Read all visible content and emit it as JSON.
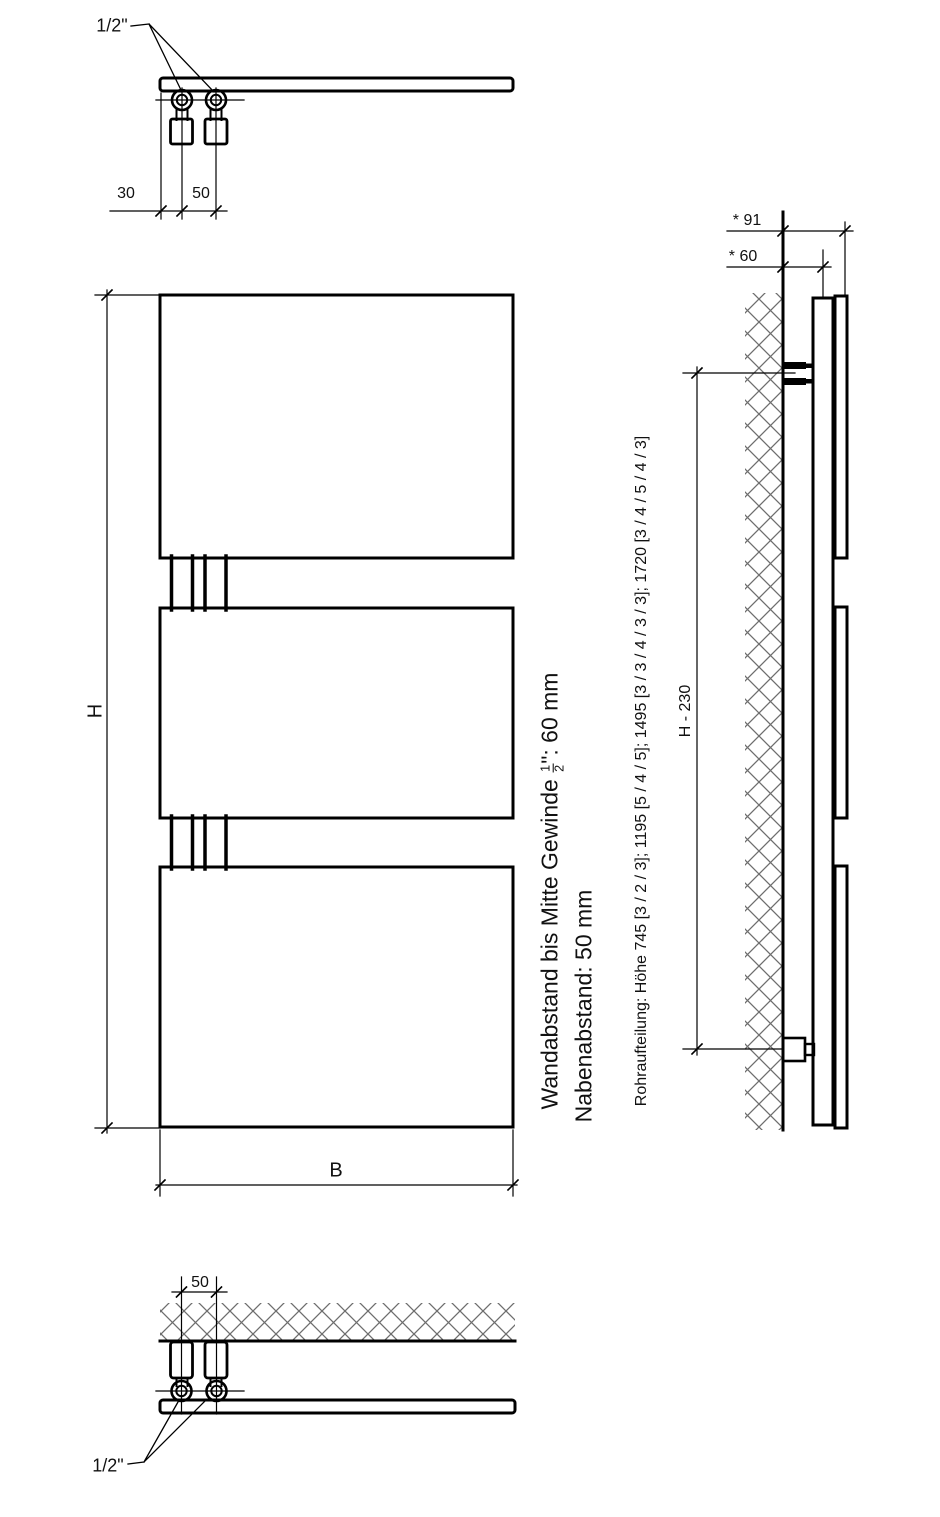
{
  "drawing": {
    "type": "radiator-technical-drawing",
    "line_color": "#000000",
    "hatch_color": "#6e6e6e",
    "top_detail": {
      "thread_label": "1/2\"",
      "dim_edge_to_pipe": "30",
      "dim_pipe_spacing": "50"
    },
    "front_view": {
      "height_label": "H",
      "width_label": "B",
      "panel_count": 3
    },
    "side_view": {
      "dim_wall_to_front": "* 91",
      "dim_wall_to_thread": "* 60",
      "dim_bracket_span": "H - 230"
    },
    "bottom_detail": {
      "dim_pipe_spacing": "50",
      "thread_label": "1/2\""
    },
    "notes": {
      "note1_prefix": "Wandabstand bis Mitte Gewinde ",
      "note1_frac_num": "1",
      "note1_frac_den": "2",
      "note1_suffix": "\": 60 mm",
      "note2": "Nabenabstand: 50 mm",
      "note3": "Rohraufteilung: Höhe 745 [3 / 2 / 3]; 1195 [5 / 4 / 5]; 1495 [3 / 3 / 4 / 3 / 3]; 1720 [3 / 4 / 5 / 4 / 3]"
    }
  }
}
